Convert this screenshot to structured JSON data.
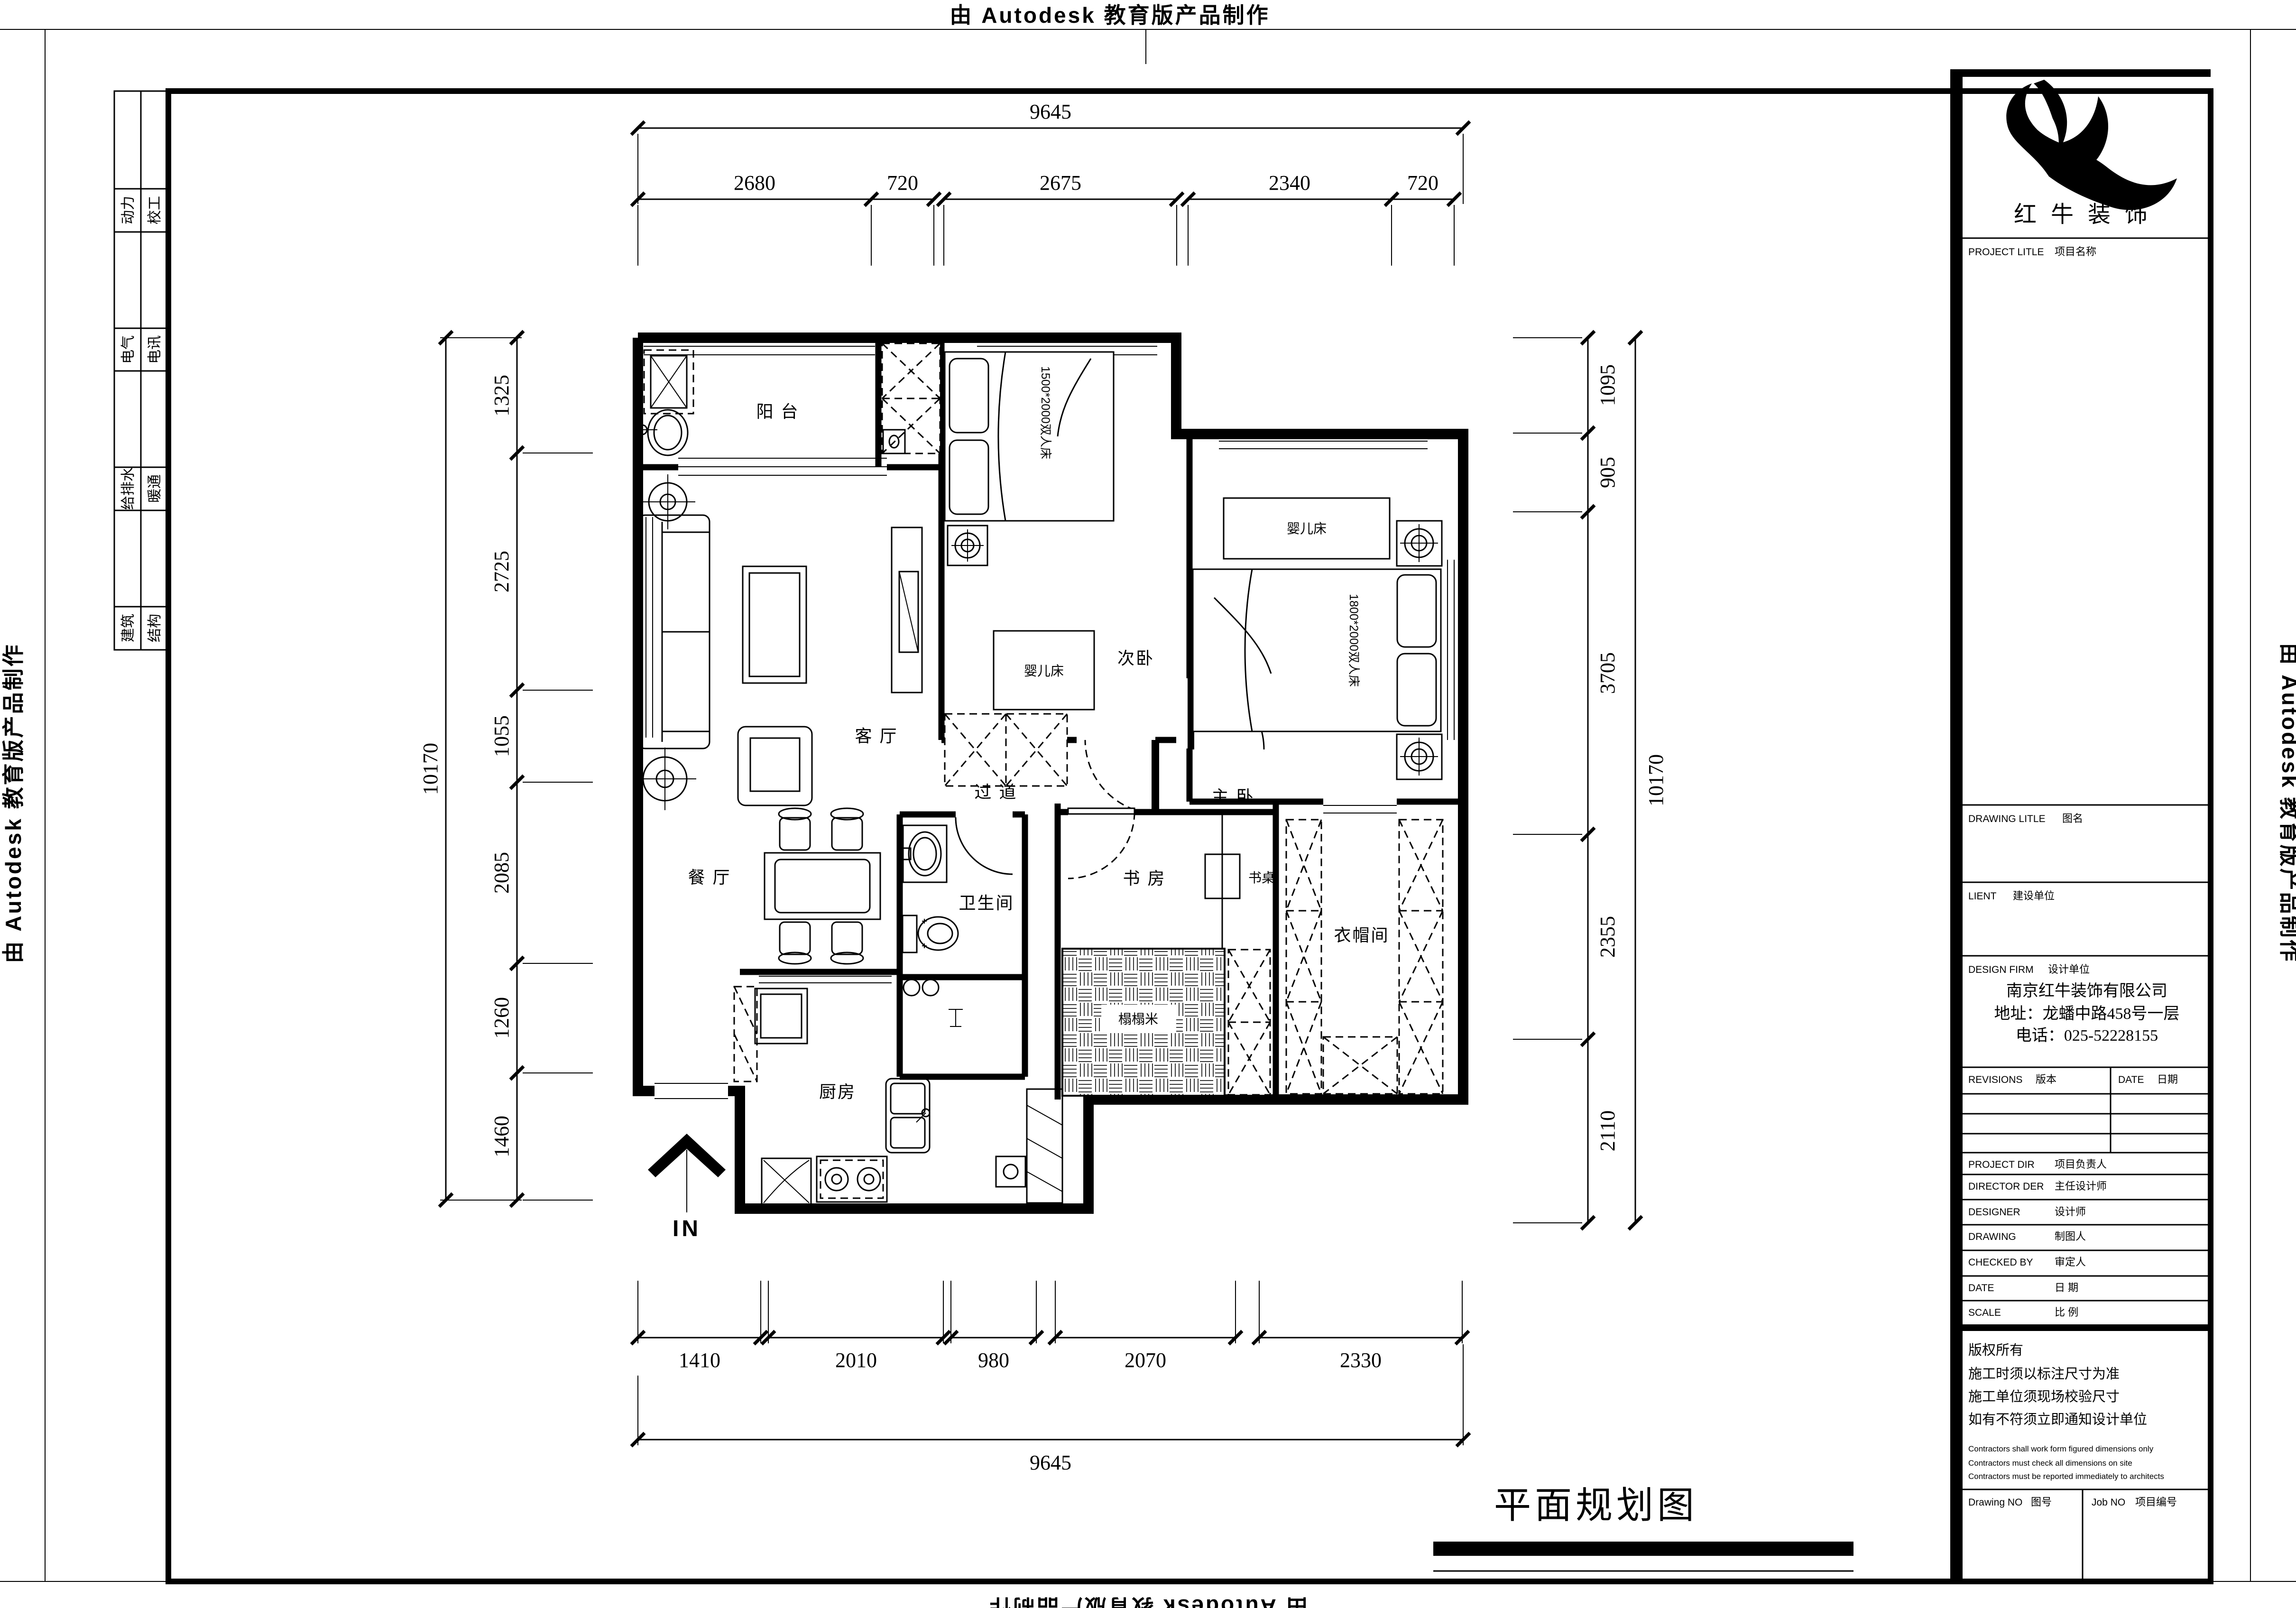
{
  "edges": {
    "top": "由 Autodesk 教育版产品制作",
    "bottom": "由 Autodesk 教育版产品制作",
    "left": "由 Autodesk 教育版产品制作",
    "right": "由 Autodesk 教育版产品制作"
  },
  "disciplines": {
    "col1": [
      "动力",
      "电气",
      "给排水",
      "建筑"
    ],
    "col2": [
      "校工",
      "电讯",
      "暖通",
      "结构"
    ]
  },
  "title_block": {
    "logo_text": "红牛装饰",
    "project_title_en": "PROJECT LITLE",
    "project_title_cn": "项目名称",
    "drawing_title_en": "DRAWING LITLE",
    "drawing_title_cn": "图名",
    "client_en": "LIENT",
    "client_cn": "建设单位",
    "design_firm_en": "DESIGN FIRM",
    "design_firm_cn": "设计单位",
    "company_name": "南京红牛装饰有限公司",
    "company_address": "地址：龙蟠中路458号一层",
    "company_phone": "电话：025-52228155",
    "revisions_en": "REVISIONS",
    "revisions_cn": "版本",
    "date_header_en": "DATE",
    "date_header_cn": "日期",
    "rows": [
      {
        "en": "PROJECT DIR",
        "cn": "项目负责人"
      },
      {
        "en": "DIRECTOR DER",
        "cn": "主任设计师"
      },
      {
        "en": "DESIGNER",
        "cn": "设计师"
      },
      {
        "en": "DRAWING",
        "cn": "制图人"
      },
      {
        "en": "CHECKED BY",
        "cn": "审定人"
      },
      {
        "en": "DATE",
        "cn": "日  期"
      },
      {
        "en": "SCALE",
        "cn": "比  例"
      }
    ],
    "copyright": "版权所有",
    "notes_cn": [
      "施工时须以标注尺寸为准",
      "施工单位须现场校验尺寸",
      "如有不符须立即通知设计单位"
    ],
    "notes_en": [
      "Contractors shall work form figured dimensions only",
      "Contractors must check all dimensions on site",
      "Contractors must be reported immediately to architects"
    ],
    "drawing_no_en": "Drawing NO",
    "drawing_no_cn": "图号",
    "job_no_en": "Job NO",
    "job_no_cn": "项目编号"
  },
  "plan": {
    "rooms": {
      "balcony": "阳 台",
      "bedroom2": "次卧",
      "master": "主 卧",
      "living": "客 厅",
      "corridor": "过 道",
      "dining": "餐 厅",
      "bath": "卫生间",
      "study": "书 房",
      "desk": "书桌",
      "tatami": "榻榻米",
      "closet": "衣帽间",
      "kitchen": "厨房"
    },
    "furniture": {
      "crib_bedroom2": "婴儿床",
      "crib_master": "婴儿床",
      "bed_bedroom2": "1500*2000双人床",
      "bed_master": "1800*2000双人床"
    },
    "entry": "IN",
    "drawing_name": "平面规划图"
  },
  "dims": {
    "top_total": "9645",
    "top": [
      "2680",
      "720",
      "2675",
      "2340",
      "720"
    ],
    "left_total": "10170",
    "left": [
      "1325",
      "2725",
      "1055",
      "2085",
      "1260",
      "1460"
    ],
    "right": [
      "1095",
      "905",
      "3705",
      "2355",
      "2110"
    ],
    "right_total": "10170",
    "bottom": [
      "1410",
      "2010",
      "980",
      "2070",
      "2330"
    ],
    "bottom_total": "9645"
  }
}
